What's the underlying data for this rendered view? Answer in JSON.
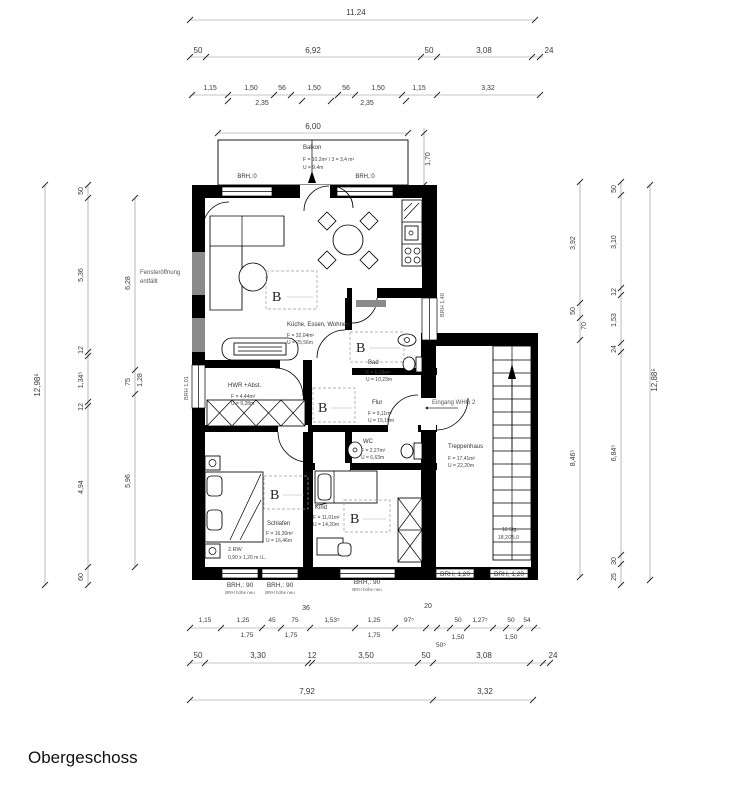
{
  "title": "Obergeschoss",
  "colors": {
    "wall": "#000000",
    "infill_grey": "#8a8a8a",
    "dim_text": "#3a3a3a"
  },
  "dims": {
    "top_total": "11.24",
    "top_row2": [
      "50",
      "6,92",
      "50",
      "3,08",
      "24"
    ],
    "top_row3": [
      "1,15",
      "1,50",
      "56",
      "1,50",
      "56",
      "1,50",
      "1,15",
      "3,32"
    ],
    "top_row3_sub": [
      "2,35",
      "2,35"
    ],
    "balcony_width": "6,00",
    "balcony_depth": "1,70",
    "left_total": "12,98⁵",
    "left_chain1": [
      "50",
      "5,36",
      "12",
      "1,34⁵",
      "12",
      "4,94",
      "60"
    ],
    "left_chain2": [
      "6,28",
      "75",
      "1,28",
      "5,96"
    ],
    "right_total": "12,88⁵",
    "right_inner": [
      "3,92",
      "50",
      "70",
      "8,46⁵"
    ],
    "right_outer": [
      "50",
      "3,10",
      "12",
      "1,53",
      "24",
      "6,84⁵",
      "30",
      "25"
    ],
    "stair_wall": "20",
    "bottom_row1": [
      "1,15",
      "1,25",
      "45",
      "75",
      "1,53⁵",
      "1,25",
      "97⁵",
      "50",
      "1,27⁵",
      "50",
      "54"
    ],
    "bottom_row1_sub": [
      "1,75",
      "1,75",
      "1,75",
      "50⁵",
      "1,50",
      "1,50"
    ],
    "bottom_row1_above": [
      "36",
      "20"
    ],
    "bottom_row2": [
      "50",
      "3,30",
      "12",
      "3,50",
      "50",
      "3,08",
      "24"
    ],
    "bottom_row3": [
      "7,92",
      "3,32"
    ]
  },
  "rooms": {
    "balkon": {
      "name": "Balkon",
      "area": "F = 10,2m² / 3 = 3,4 m²",
      "perimeter": "U = 9,4m"
    },
    "wohnen": {
      "name": "Küche, Essen, Wohnen",
      "area": "F = 32,04m²",
      "perimeter": "U = 25,56m"
    },
    "bad": {
      "name": "Bad",
      "area": "F = 6,26m²",
      "perimeter": "U = 10,23m"
    },
    "hwr": {
      "name": "HWR +Abst.",
      "area": "F = 4,44m²",
      "perimeter": "U = 9,28m"
    },
    "flur": {
      "name": "Flur",
      "area": "F = 9,11m²",
      "perimeter": "U = 15,10m"
    },
    "wc": {
      "name": "WC",
      "area": "F = 2,27m²",
      "perimeter": "U = 6,63m"
    },
    "schlafen": {
      "name": "Schlafen",
      "area": "F = 16,30m²",
      "perimeter": "U = 16,46m"
    },
    "kind": {
      "name": "Kind",
      "area": "F = 11,01m²",
      "perimeter": "U = 14,20m"
    },
    "treppenhaus": {
      "name": "Treppenhaus",
      "area": "F = 17,41m²",
      "perimeter": "U = 22,20m"
    }
  },
  "annotations": {
    "brh0": "BRH,:0",
    "brh90": "BRH,: 90",
    "brh90_sub": "BRH höhe neu",
    "brh120": "BRH, 1,20",
    "brh101": "BRH 1,01",
    "brh140": "BRH 1,40",
    "fenster1": "Fensteröffnung",
    "fenster2": "entfällt",
    "eingang": "Eingang WHG 2",
    "rw1": "2.RW",
    "rw2": "0,90 x 1,20 m i.L.",
    "stairs1": "16 Stg.",
    "stairs2": "18,2/25,0",
    "b": "B"
  }
}
